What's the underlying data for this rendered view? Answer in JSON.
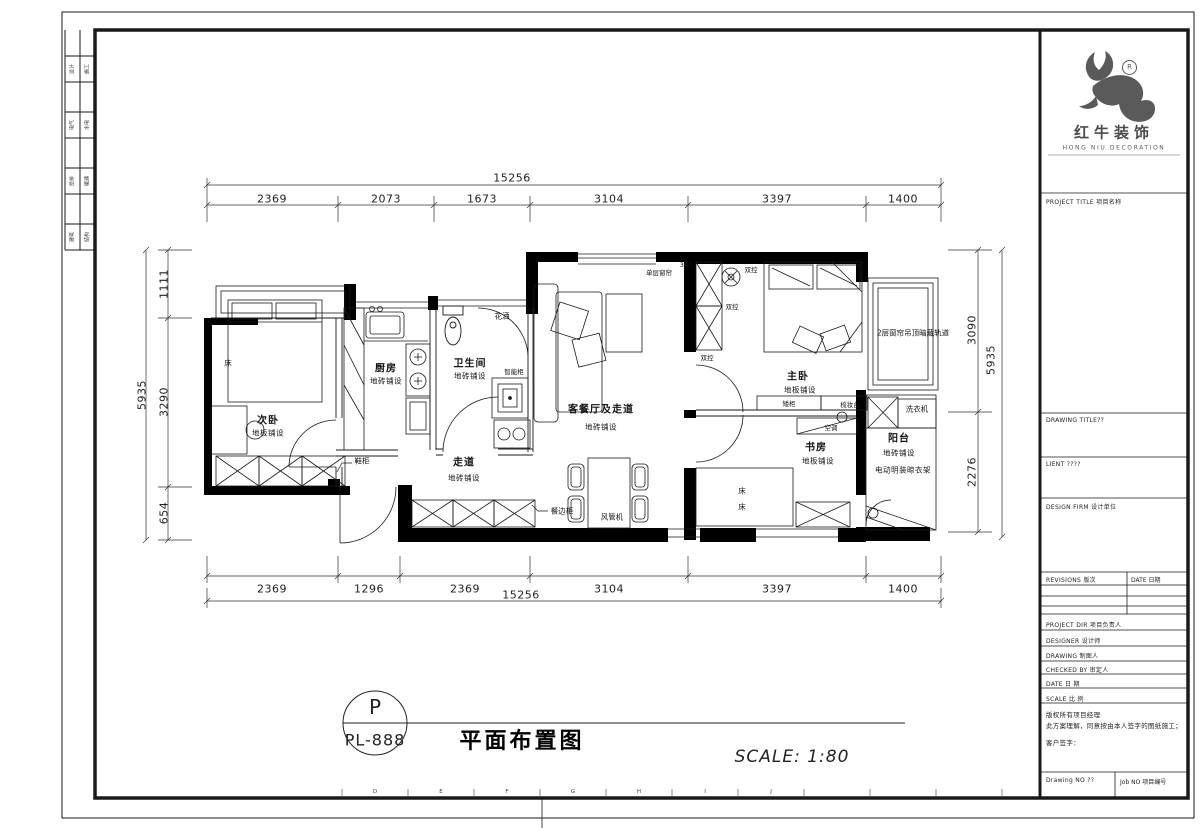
{
  "sheet": {
    "grid_letters": [
      "D",
      "E",
      "F",
      "G",
      "H",
      "I",
      "J"
    ],
    "margin_cells": [
      [
        "设计",
        "施工"
      ],
      [
        "电气",
        "水电"
      ],
      [
        "给排",
        "暖通"
      ],
      [
        "建筑",
        "结构"
      ]
    ]
  },
  "title_block": {
    "brand_cn": "红牛装饰",
    "brand_en": "HONG NIU DECORATION",
    "registered": "R",
    "project_title": "PROJECT TITLE 项目名称",
    "drawing_title": "DRAWING TITLE??",
    "client": "LIENT ????",
    "design_firm": "DESIGN FIRM 设计单位",
    "revisions": "REVISIONS 版次",
    "date_col": "DATE 日期",
    "rows": [
      "PROJECT DIR 项目负责人",
      "DESIGNER 设计师",
      "DRAWING 制图人",
      "CHECKED BY 审定人",
      "DATE 日 期",
      "SCALE 比 例"
    ],
    "note1": "版权所有项目经理",
    "note2": "此方案理解，同意按由本人签字的图纸施工；",
    "note3": "客户签字：",
    "drawing_no": "Drawing NO ??",
    "job_no": "Job NO 项目编号"
  },
  "titlebar": {
    "tag_top": "P",
    "tag_code": "PL-888",
    "title": "平面布置图",
    "scale": "SCALE: 1:80"
  },
  "dimensions": {
    "top": {
      "total": "15256",
      "segments": [
        "2369",
        "2073",
        "1673",
        "3104",
        "3397",
        "1400"
      ]
    },
    "bottom": {
      "total": "15256",
      "segments": [
        "2369",
        "1296",
        "2369",
        "3104",
        "3397",
        "1400"
      ]
    },
    "left": {
      "total": "5935",
      "segments": [
        "1111",
        "3290",
        "654"
      ]
    },
    "right": {
      "total": "5935",
      "segments": [
        "3090",
        "2276"
      ]
    }
  },
  "rooms": {
    "bedroom2": {
      "name": "次卧",
      "finish": "地板铺设"
    },
    "kitchen": {
      "name": "厨房",
      "finish": "地砖铺设"
    },
    "bathroom": {
      "name": "卫生间",
      "finish": "地砖铺设"
    },
    "living": {
      "name": "客餐厅及走道",
      "finish": "地砖铺设"
    },
    "corridor": {
      "name": "走道",
      "finish": "地砖铺设"
    },
    "master": {
      "name": "主卧",
      "finish": "地板铺设"
    },
    "study": {
      "name": "书房",
      "finish": "地板铺设"
    },
    "balcony": {
      "name": "阳台",
      "finish": "地砖铺设",
      "extra": "电动明装晾衣架"
    }
  },
  "annotations": {
    "bed2": "床",
    "shoe_cabinet": "鞋柜",
    "sideboard": "餐边柜",
    "duct_ac": "风管机",
    "shower": "花洒",
    "vanity": "智能柜",
    "curtain_single": "单层窗帘",
    "num350": "350",
    "switch1": "双控",
    "switch2": "双控",
    "switch3": "双控",
    "low_cabinet": "矮柜",
    "dresser": "梳妆台",
    "ac": "空调",
    "bed_s1": "床",
    "bed_s2": "床",
    "curtain_track": "2层窗帘吊顶暗藏轨道",
    "washer": "洗衣机"
  }
}
